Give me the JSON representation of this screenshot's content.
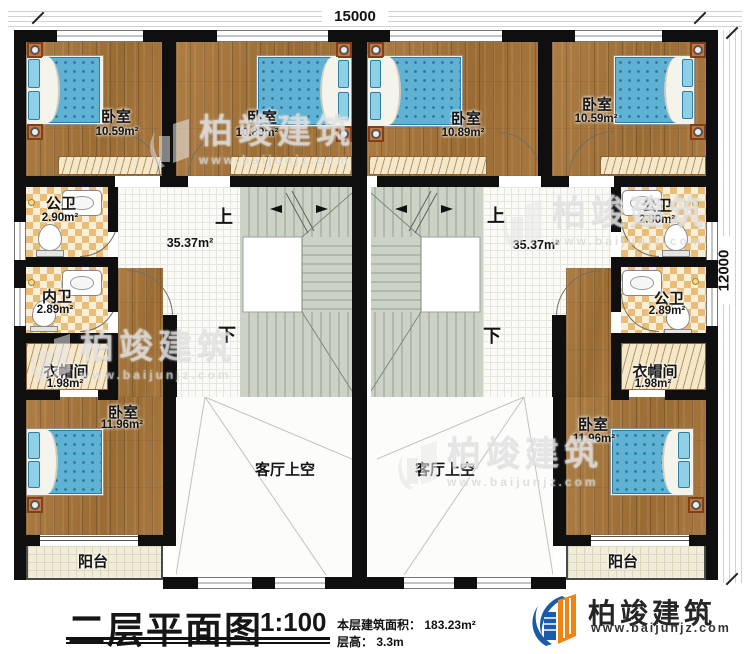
{
  "dimensions": {
    "top": "15000",
    "right": "12000"
  },
  "stairs": {
    "up": "上",
    "down": "下"
  },
  "rooms": {
    "bedroom_tl": {
      "name": "卧室",
      "area": "10.59m²"
    },
    "bedroom_tml": {
      "name": "卧室",
      "area": "10.89m²"
    },
    "bedroom_tmr": {
      "name": "卧室",
      "area": "10.89m²"
    },
    "bedroom_tr": {
      "name": "卧室",
      "area": "10.59m²"
    },
    "bath_left_top": {
      "name": "公卫",
      "area": "2.90m²"
    },
    "bath_left_mid": {
      "name": "内卫",
      "area": "2.89m²"
    },
    "closet_left": {
      "name": "衣帽间",
      "area": "1.98m²"
    },
    "bedroom_bl": {
      "name": "卧室",
      "area": "11.96m²"
    },
    "balcony_left": {
      "name": "阳台"
    },
    "hall_left": {
      "area": "35.37m²"
    },
    "void_left": {
      "name": "客厅上空"
    },
    "bath_right_top": {
      "name": "公卫",
      "area": "2.90m²"
    },
    "bath_right_mid": {
      "name": "公卫",
      "area": "2.89m²"
    },
    "closet_right": {
      "name": "衣帽间",
      "area": "1.98m²"
    },
    "bedroom_br": {
      "name": "卧室",
      "area": "11.96m²"
    },
    "balcony_right": {
      "name": "阳台"
    },
    "hall_right": {
      "area": "35.37m²"
    },
    "void_right": {
      "name": "客厅上空"
    }
  },
  "titleblock": {
    "title": "二层平面图",
    "scale": "1:100",
    "area_label": "本层建筑面积：",
    "area_value": "183.23m²",
    "height_label": "层高：",
    "height_value": "3.3m"
  },
  "brand": {
    "name": "柏竣建筑",
    "url": "www.baijunjz.com"
  },
  "watermark": {
    "brand": "柏竣建筑",
    "url": "www.baijunjz.com"
  }
}
